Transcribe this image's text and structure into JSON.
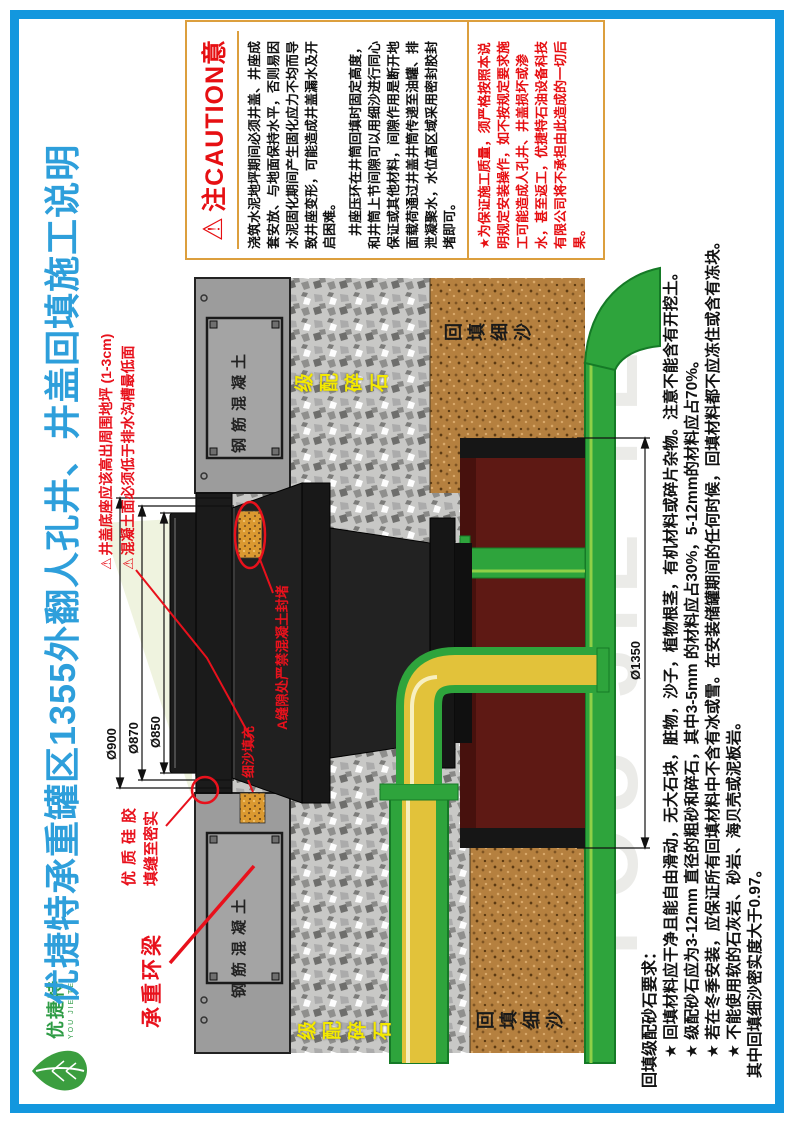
{
  "logo": {
    "cn": "优捷特",
    "en": "YOU JIE TE"
  },
  "title": {
    "text": "优捷特承重罐区1355外翻人孔井、井盖回填施工说明",
    "color": "#2E9FDB"
  },
  "caution": {
    "icon": "⚠",
    "header": "注CAUTION意",
    "p1a": "浇筑水泥地坪期间必须井盖、井座成套安放、与地面保持水平，否则易因水泥固化期间产生固化应力不均而导致井座变形，可能造成井盖漏水及开启困难。",
    "p1b": "井座压环在井筒回填时固定高度，和井筒上节间隙可以用细沙进行同心保证或其他材料，间隙作用是断开地面载荷通过井盖井筒传递至油罐、排泄凝聚水，水位高区域采用密封胶封堵即可。",
    "p2": "★为保证施工质量，须严格按照本说明规定安装操作，如不按规定要求施工可能造成人孔井、井盖损坏或渗水，甚至返工，优捷特石油设备科技有限公司将不承担由此造成的一切后果。"
  },
  "requirements": {
    "title": "回填级配砂石要求：",
    "items": [
      "★ 回填材料应干净且能自由滑动，无大石块，脏物，沙子，植物根茎，有机材料或碎片杂物。注意不能含有开挖土。",
      "★ 级配砂石应为3-12mm 直径的粗砂和碎石，其中3-5mm 的材料应占30%，5-12mm的材料应占70%。",
      "★ 若在冬季安装，应保证所有回填材料中不含有冰或雪。在安装储罐期间的任何时候，回填材料都不应冻住或含有冻块。",
      "★ 不能使用软的石灰岩、砂岩、海贝壳或泥板岩。"
    ],
    "footer": "其中回填细沙密实度大于0.97。"
  },
  "diagram": {
    "watermark": "YOU JIE TE",
    "warn_icon": "⚠",
    "dims": [
      "Ø900",
      "Ø870",
      "Ø850",
      "Ø1350"
    ],
    "note1": "井盖底座应该高出周围地坪 (1-3cm)",
    "note2": "混凝土面必须低于排水沟槽最低面",
    "silicone1": "优质硅胶",
    "silicone2": "填缝至密实",
    "ring_beam": "承重环梁",
    "sand_fill": "细沙填充",
    "gap_note": "A缝隙处严禁混凝土封堵",
    "slab_label": "钢筋混凝土",
    "gravel_label": "级配碎石",
    "sand_label": "回填细沙"
  },
  "colors": {
    "frame_blue": "#1397DE",
    "title_blue": "#2E9FDB",
    "caution_orange": "#DC9F3E",
    "warning_red": "#E60F12",
    "annotation_red": "#E8111C",
    "label_yellow": "#F4E900",
    "tank_green": "#2EA43C",
    "tank_red": "#5E1914",
    "pipe_yellow": "#E2C23A",
    "sand_brown": "#B5803F",
    "gravel_gray": "#C8C8C6"
  }
}
